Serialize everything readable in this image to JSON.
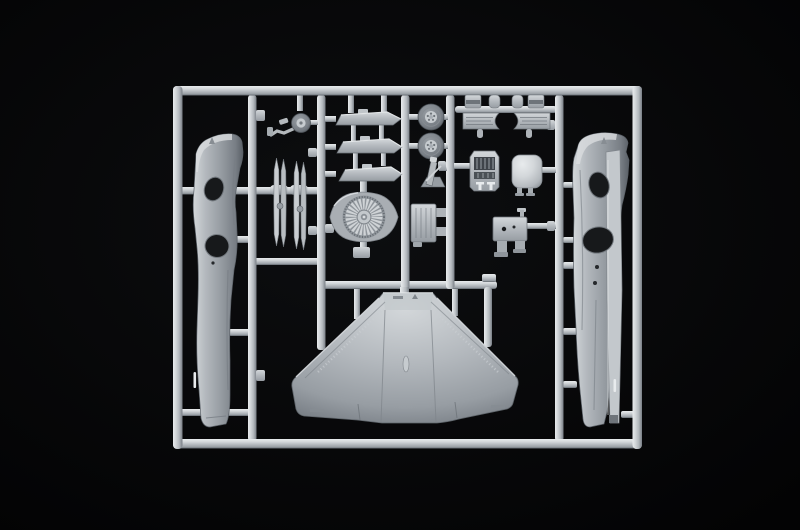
{
  "scene": {
    "description": "Photograph of a light-grey injection-molded plastic model kit sprue (parts frame) for a jet aircraft, on a black background",
    "parts": [
      {
        "name": "sprue-frame",
        "label": "rectangular sprue frame"
      },
      {
        "name": "left-fuselage-half",
        "label": "left fuselage half with cockpit and wheel-well openings"
      },
      {
        "name": "right-fuselage-half",
        "label": "right fuselage half with cockpit and wheel-well openings"
      },
      {
        "name": "main-wing",
        "label": "one-piece swept delta wing"
      },
      {
        "name": "engine-fan",
        "label": "engine intake fan disc"
      },
      {
        "name": "stabilizers",
        "label": "three flat swept stabilizer/flap pieces"
      },
      {
        "name": "drop-tank-blades",
        "label": "two pairs of thin drop-tank half sections"
      },
      {
        "name": "nose-gear",
        "label": "nose landing gear strut with wheel"
      },
      {
        "name": "main-wheels",
        "label": "two main landing-gear wheels"
      },
      {
        "name": "intake-halves",
        "label": "intake trunk halves with circular cutout and small caps"
      },
      {
        "name": "instrument-panel",
        "label": "cockpit instrument console"
      },
      {
        "name": "tank-pod",
        "label": "rounded tank/pod part with legs"
      },
      {
        "name": "ejection-seat",
        "label": "ejection seat"
      },
      {
        "name": "airbrake-box",
        "label": "ribbed airbrake/equipment box with side tabs"
      },
      {
        "name": "sensor-box",
        "label": "small box part with two holes and legs"
      }
    ]
  },
  "colors": {
    "background_center": "#0d0e10",
    "background_edge": "#030304",
    "highlight": "#e8ebed",
    "plastic_light": "#d3d7da",
    "plastic": "#b3b8bd",
    "plastic_mid": "#979da3",
    "plastic_dark": "#787e85",
    "plastic_deep": "#5a6067",
    "recess": "#8f959b",
    "hole_dark": "#17191b",
    "hole_mid": "#35393d"
  }
}
